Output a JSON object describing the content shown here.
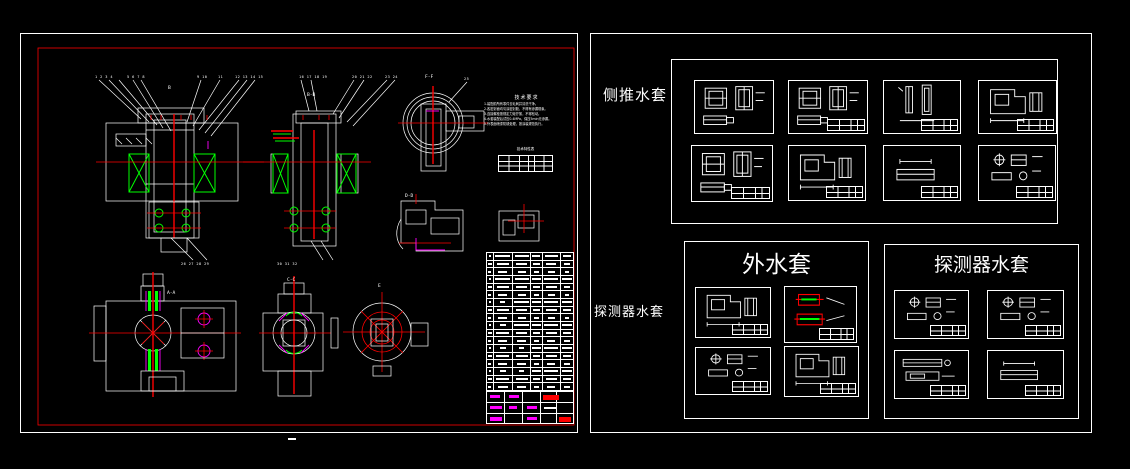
{
  "canvas": {
    "background": "#000000"
  },
  "palette": {
    "line": "#ffffff",
    "centerline": "#ff0000",
    "hatch": "#00ff00",
    "detail": "#ff00ff"
  },
  "left_sheet": {
    "labels": {
      "bb": "B-B",
      "ff": "F-F",
      "dd": "D-D",
      "aa": "A-A",
      "cc": "C-C",
      "ee": "E",
      "section_b": "B"
    },
    "callouts": {
      "c0": "1 2 3 4",
      "c1": "5 6 7 8",
      "c2": "9 10",
      "c3": "11",
      "c4": "12 13 14 15",
      "c5": "16 17 18 19",
      "c6": "20 21 22",
      "c7": "23 24",
      "c8": "25",
      "b0": "26 27 28 29",
      "b1": "30 31 32"
    },
    "tech_notes": {
      "title": "技术要求",
      "items": [
        "1.装配前所有零件去毛刺并清洗干净。",
        "2.各密封面均匀涂密封胶，不得有渗漏现象。",
        "3.连接螺栓按规定力矩拧紧，不得松动。",
        "4.水套装配后试压0.4MPa，保压5min无渗漏。",
        "5.外表面喷漆防锈处理，按涂装规范执行。"
      ]
    },
    "spec_table_title": "技术特性表",
    "bom_rows": 18,
    "bom_cols": [
      6,
      20,
      19,
      11,
      19,
      13
    ],
    "footer_mark": "-"
  },
  "right_area": {
    "label_side_thruster": "侧推水套",
    "label_detector_side": "探测器水套",
    "outer_jacket_title": "外水套",
    "detector_jacket_title": "探测器水套"
  }
}
